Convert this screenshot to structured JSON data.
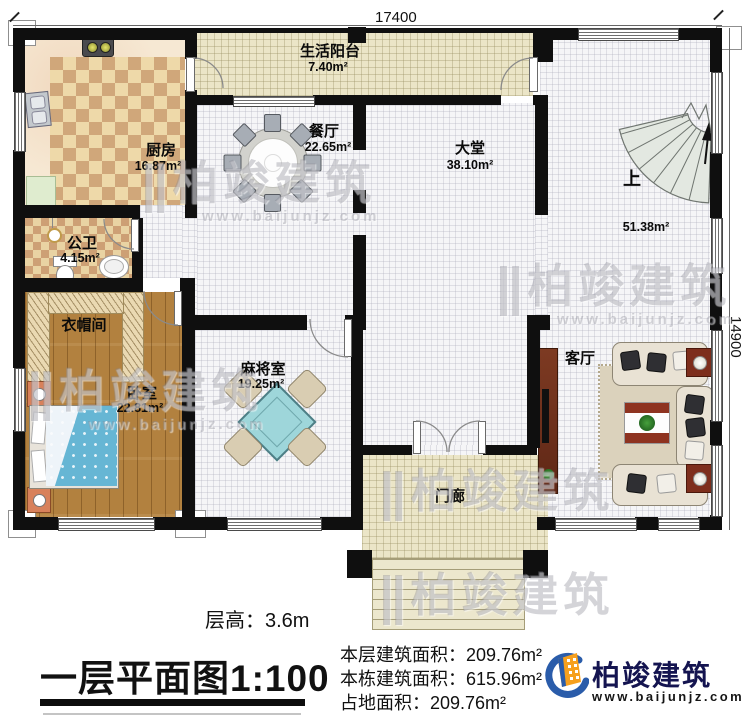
{
  "plan": {
    "dim_top": "17400",
    "dim_right": "14900",
    "rooms": [
      {
        "name": "生活阳台",
        "area": "7.40m²"
      },
      {
        "name": "厨房",
        "area": "16.87m²"
      },
      {
        "name": "餐厅",
        "area": "22.65m²"
      },
      {
        "name": "大堂",
        "area": "38.10m²"
      },
      {
        "name": "上",
        "area": "51.38m²"
      },
      {
        "name": "公卫",
        "area": "4.15m²"
      },
      {
        "name": "衣帽间",
        "area": ""
      },
      {
        "name": "卧室",
        "area": "22.81m²"
      },
      {
        "name": "麻将室",
        "area": "19.25m²"
      },
      {
        "name": "客厅",
        "area": ""
      },
      {
        "name": "门廊",
        "area": ""
      }
    ]
  },
  "title_block": {
    "floor_height": "层高：3.6m",
    "title": "一层平面图",
    "scale": "1:100",
    "stats": [
      "本层建筑面积：209.76m²",
      "本栋建筑面积：615.96m²",
      "占地面积：209.76m²"
    ]
  },
  "brand": {
    "name": "柏竣建筑",
    "website": "www.baijunjz.com"
  },
  "watermark": {
    "mark": "||",
    "text": "柏竣建筑",
    "sub": "www.baijunjz.com"
  },
  "colors": {
    "wall": "#0f0f0f",
    "brand_blue": "#2a5caa",
    "brand_orange": "#f6a01e",
    "bed_blue": "#66b6d4",
    "mahjong_cyan": "#9ed6da"
  }
}
